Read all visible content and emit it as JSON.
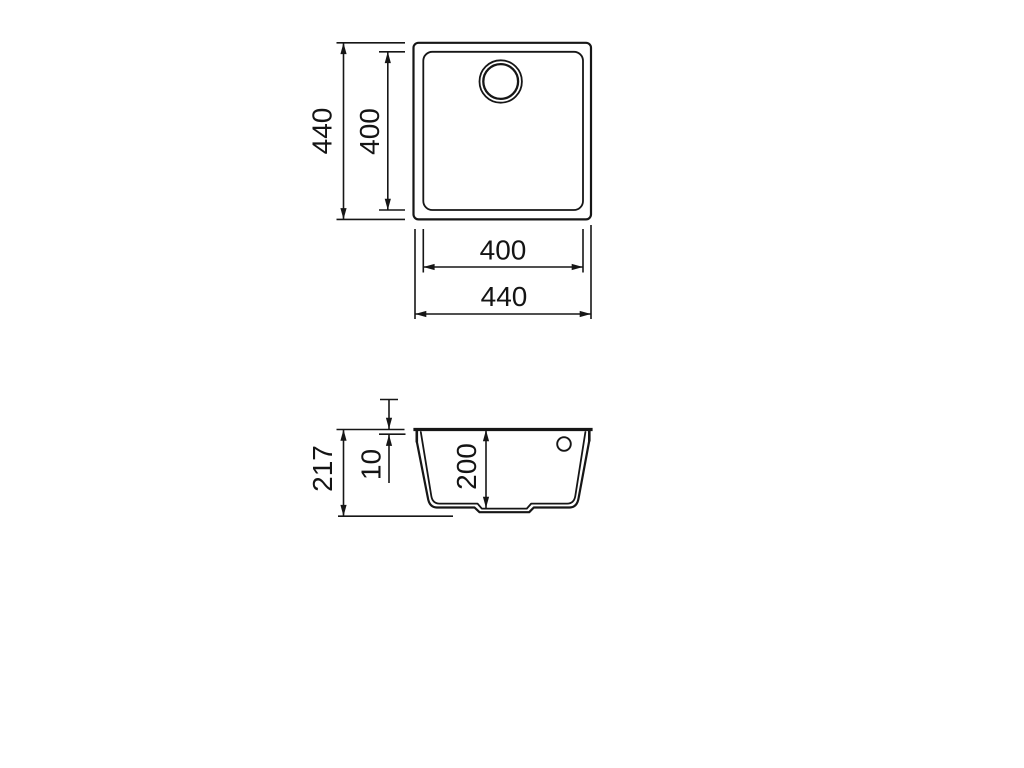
{
  "colors": {
    "background": "#ffffff",
    "line": "#161616",
    "text": "#141414"
  },
  "views": {
    "top": {
      "dim_height_outer": "440",
      "dim_height_inner": "400",
      "dim_width_inner": "400",
      "dim_width_outer": "440"
    },
    "section": {
      "dim_total_height": "217",
      "dim_rim_thickness": "10",
      "dim_bowl_depth": "200"
    }
  }
}
